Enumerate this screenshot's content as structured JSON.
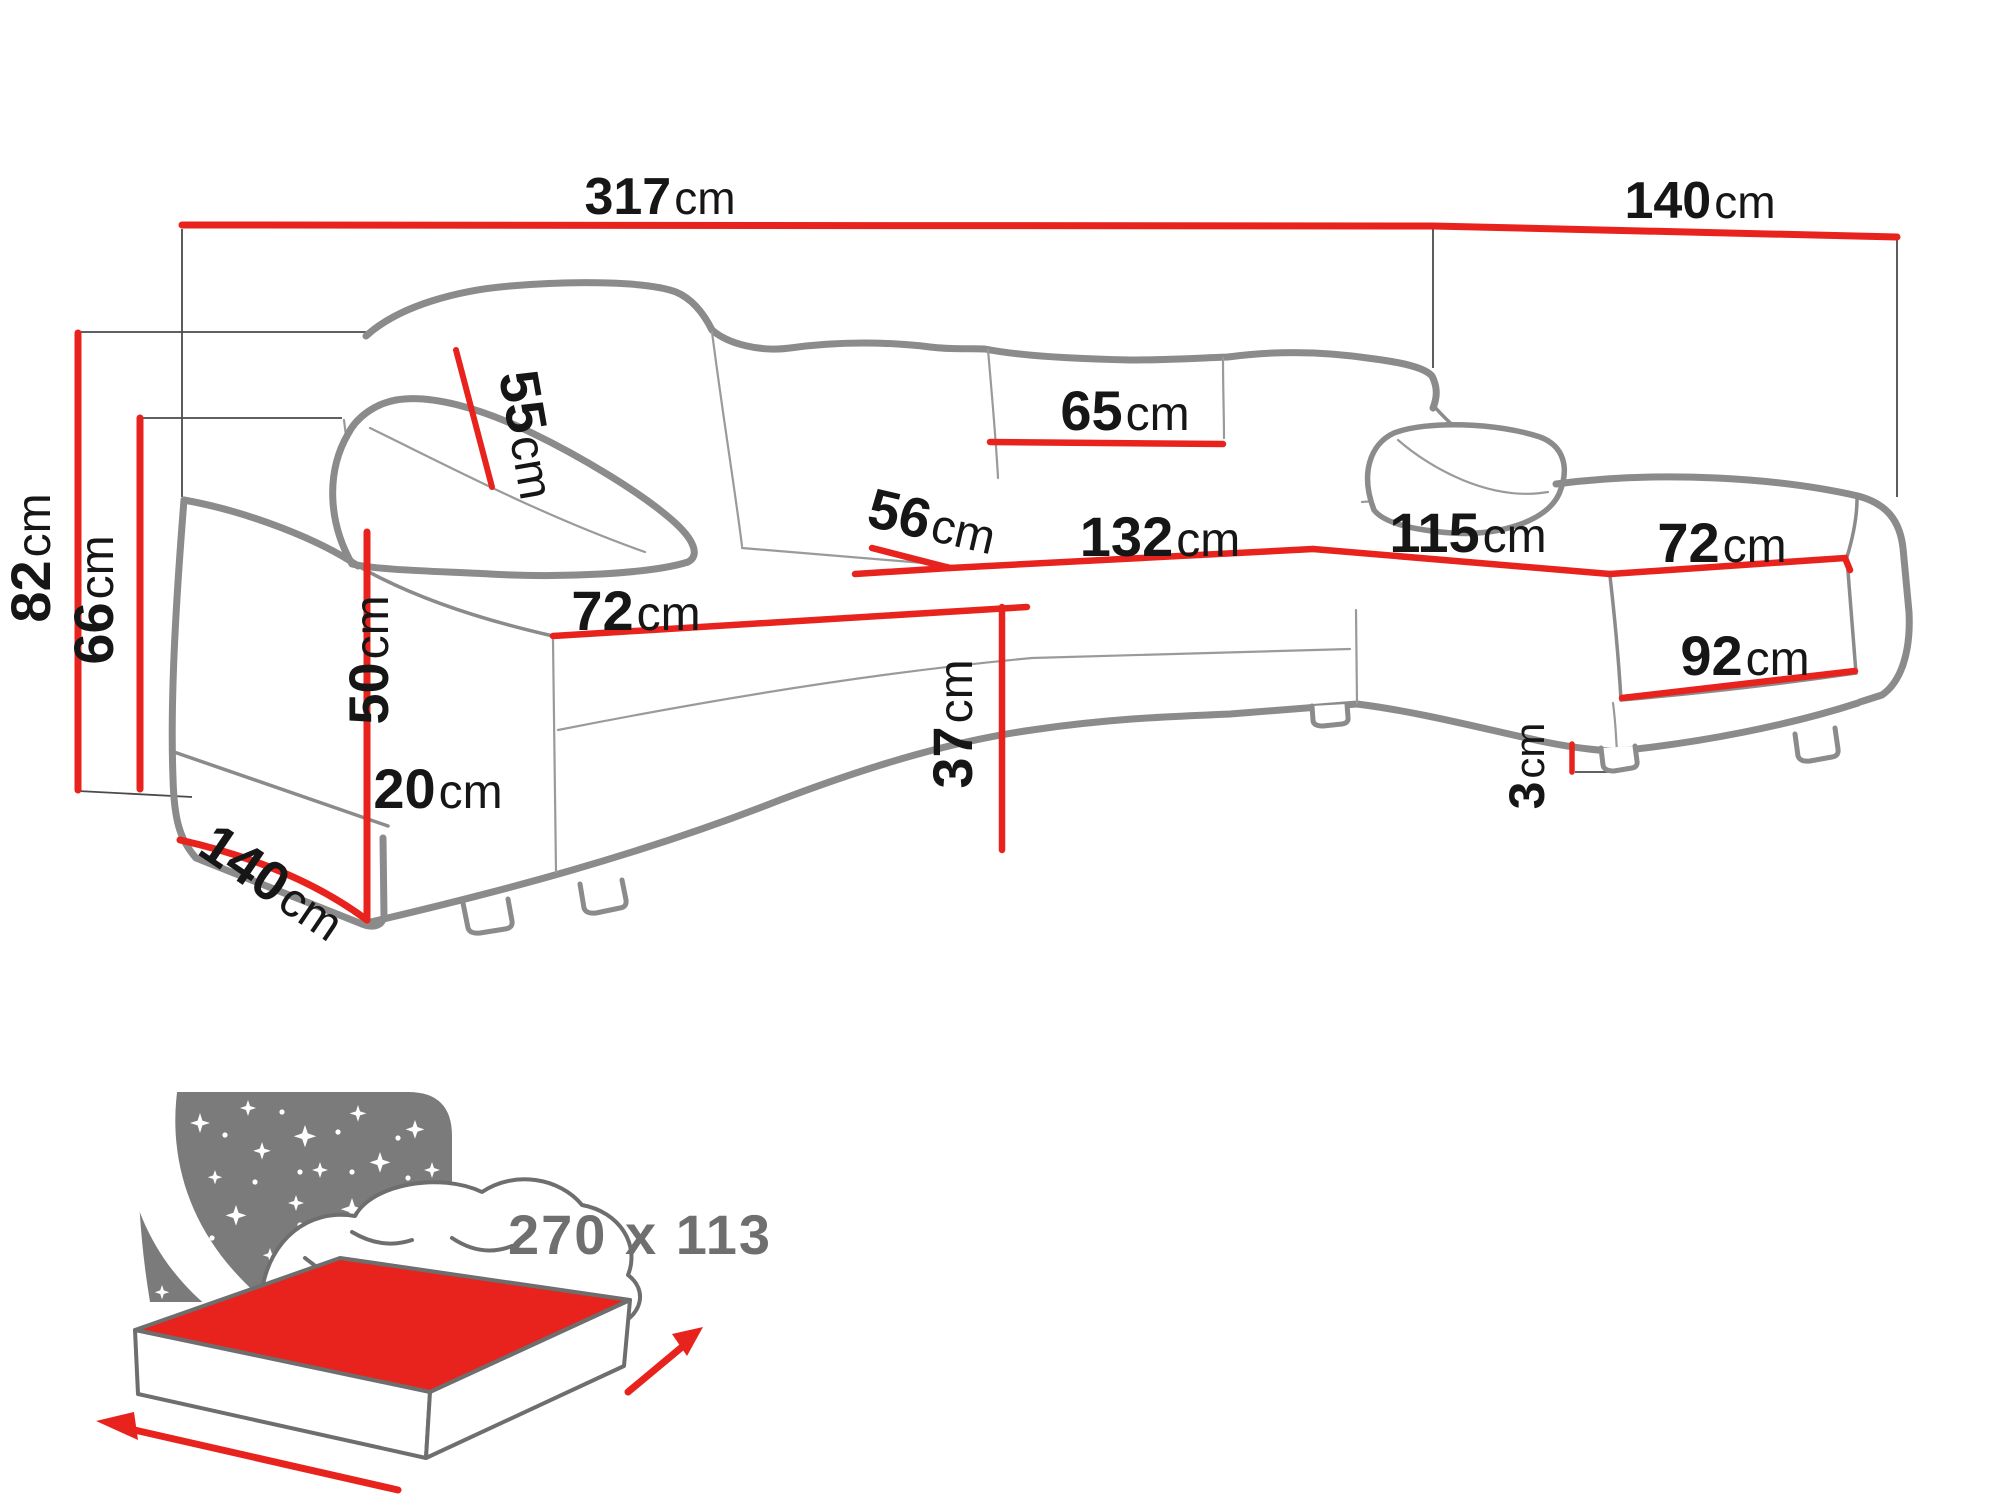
{
  "figure": {
    "type": "sofa-dimension-diagram",
    "description": "U-shaped corner sofa line drawing with red dimension lines",
    "unit": "cm"
  },
  "colors": {
    "dimension_red": "#e8231d",
    "outline_gray": "#8b8b8b",
    "label_black": "#161616",
    "icon_gray": "#7b7b7b",
    "sleep_text_gray": "#6f6f6f",
    "background": "#ffffff"
  },
  "dimensions": {
    "total_width": {
      "value": "317",
      "unit": "cm"
    },
    "right_depth": {
      "value": "140",
      "unit": "cm"
    },
    "total_height": {
      "value": "82",
      "unit": "cm"
    },
    "backrest_height": {
      "value": "66",
      "unit": "cm"
    },
    "cushion_height": {
      "value": "55",
      "unit": "cm"
    },
    "back_cushion_width": {
      "value": "65",
      "unit": "cm"
    },
    "seat_depth": {
      "value": "56",
      "unit": "cm"
    },
    "middle_seat_width": {
      "value": "132",
      "unit": "cm"
    },
    "right_seat_length": {
      "value": "115",
      "unit": "cm"
    },
    "right_seat_width": {
      "value": "72",
      "unit": "cm"
    },
    "left_seat_width": {
      "value": "72",
      "unit": "cm"
    },
    "armrest_height": {
      "value": "50",
      "unit": "cm"
    },
    "left_depth_diagonal": {
      "value": "140",
      "unit": "cm"
    },
    "base_height": {
      "value": "20",
      "unit": "cm"
    },
    "seat_height": {
      "value": "37",
      "unit": "cm"
    },
    "right_front_width": {
      "value": "92",
      "unit": "cm"
    },
    "leg_height": {
      "value": "3",
      "unit": "cm"
    }
  },
  "sleeping_area": {
    "label": "270 x 113"
  }
}
